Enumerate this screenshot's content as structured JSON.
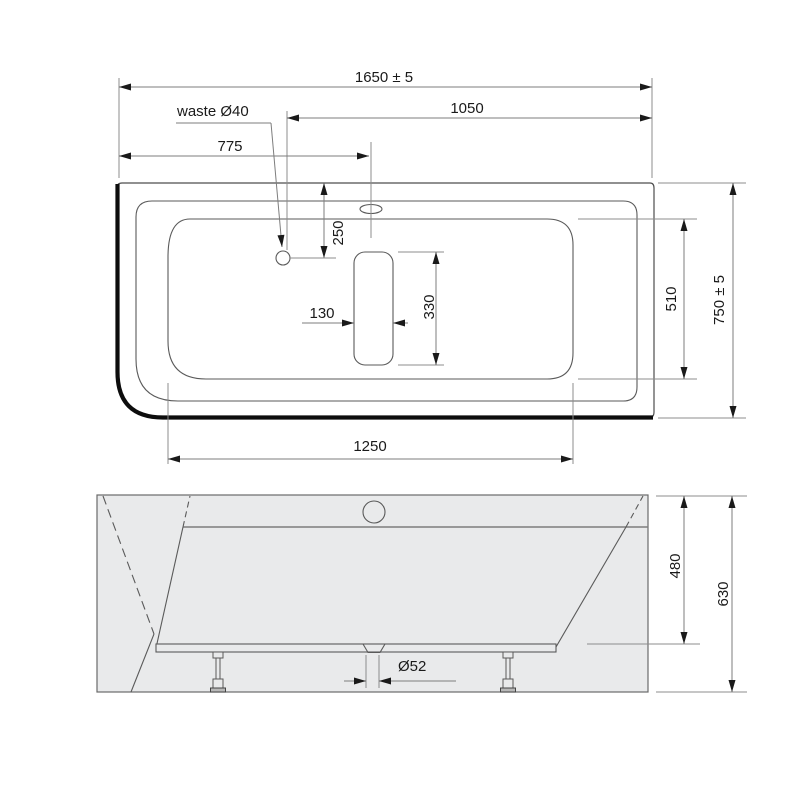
{
  "drawing": {
    "type": "bathtub technical drawing, plan view and front elevation",
    "colors": {
      "background": "#ffffff",
      "body_fill": "#e9eaeb",
      "outline": "#4d4d4d",
      "thick_edge": "#0d0d0d",
      "dimension_lines": "#7d7d7d",
      "text": "#1a1a1a"
    }
  },
  "top_view": {
    "dimensions": {
      "overall_length": "1650 ± 5",
      "length_to_waste": "1050",
      "length_to_overflow": "775",
      "waste_label": "waste Ø40",
      "waste_offset_from_edge": "250",
      "cutout_width": "130",
      "cutout_length": "330",
      "basin_width": "510",
      "overall_width": "750 ± 5",
      "basin_length": "1250"
    }
  },
  "front_view": {
    "dimensions": {
      "drain_diameter": "Ø52",
      "rim_to_bottom_height": "480",
      "overall_height": "630"
    }
  }
}
